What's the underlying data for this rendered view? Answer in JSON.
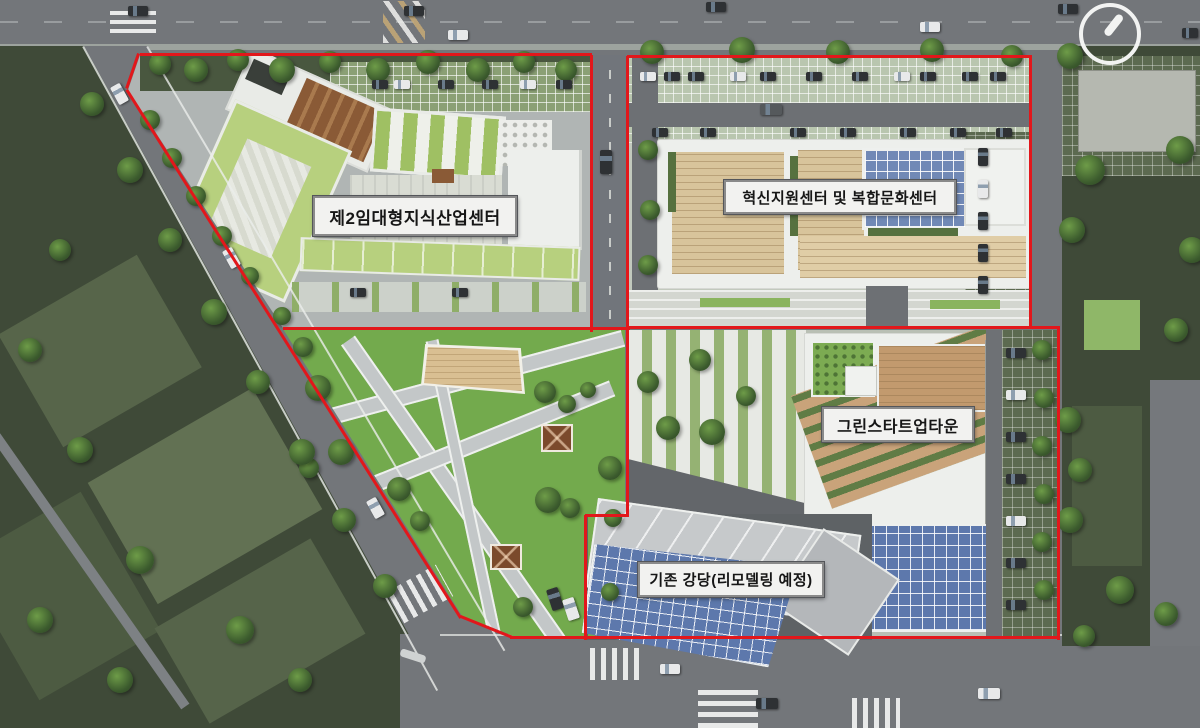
{
  "page": {
    "type": "architectural-site-plan"
  },
  "zones": {
    "industry_center": {
      "label": "제2임대형지식산업센터"
    },
    "innovation_center": {
      "label": "혁신지원센터 및 복합문화센터"
    },
    "green_startup_town": {
      "label": "그린스타트업타운"
    },
    "auditorium": {
      "label": "기존 강당(리모델링 예정)"
    }
  },
  "icons": {
    "compass": "north-arrow-icon"
  },
  "colors": {
    "boundary_red": "#e2171b",
    "park_green": "#73aa4d",
    "dark_green": "#3f4a38",
    "road_gray": "#73767a",
    "plaza_gray": "#b0b5b4",
    "building_white": "#edefec",
    "building_green_roof": "#b7d07e",
    "wood_deck": "#d8c49b",
    "solar_blue": "#7189b6",
    "solar_blue_dark": "#5d78ac",
    "label_bg": "#f2f2f0",
    "label_border": "#8a8a8a",
    "label_text": "#161616"
  }
}
